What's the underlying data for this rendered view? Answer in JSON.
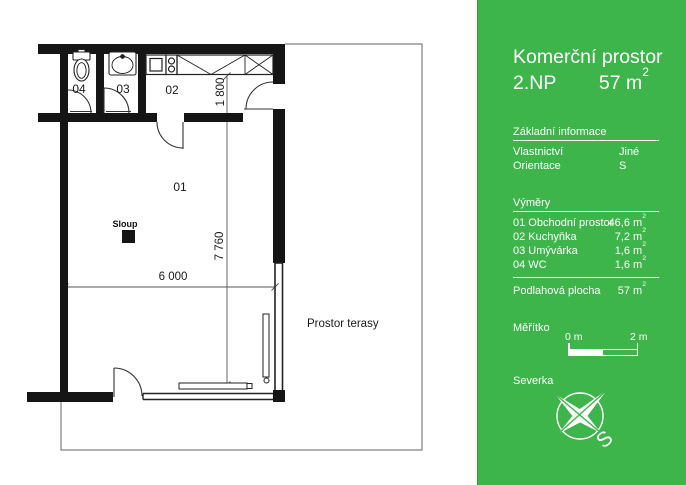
{
  "colors": {
    "panel_green": "#3db54a",
    "panel_green_dark": "#2f9e3e",
    "wall_black": "#151515"
  },
  "panel": {
    "title": "Komerční prostor",
    "floor": "2.NP",
    "area_value": "57 m",
    "sup": "2",
    "basic": {
      "heading": "Základní informace",
      "rows": [
        {
          "label": "Vlastnictví",
          "value": "Jiné"
        },
        {
          "label": "Orientace",
          "value": "S"
        }
      ]
    },
    "vymery": {
      "heading": "Výměry",
      "rows": [
        {
          "label": "01 Obchodní prostor",
          "value": "46,6 m"
        },
        {
          "label": "02 Kuchyňka",
          "value": "7,2 m"
        },
        {
          "label": "03 Umývárka",
          "value": "1,6 m"
        },
        {
          "label": "04 WC",
          "value": "1,6 m"
        }
      ]
    },
    "floor_area": {
      "label": "Podlahová plocha",
      "value": "57 m"
    },
    "scale": {
      "heading": "Měřítko",
      "start": "0 m",
      "end": "2 m"
    },
    "north": {
      "heading": "Severka",
      "letter": "S"
    }
  },
  "plan": {
    "rooms": {
      "r01": "01",
      "r02": "02",
      "r03": "03",
      "r04": "04"
    },
    "column_label": "Sloup",
    "terrace_label": "Prostor terasy",
    "dims": {
      "width": "6 000",
      "height": "7 760",
      "kitchen_depth": "1 800"
    }
  }
}
